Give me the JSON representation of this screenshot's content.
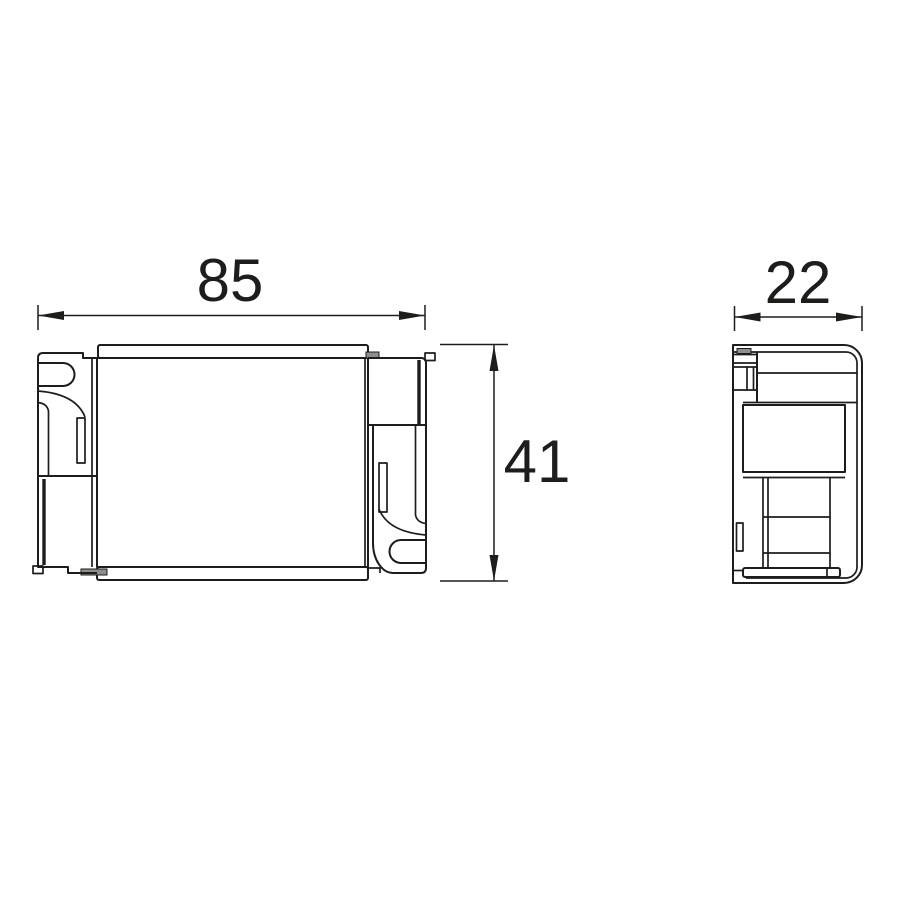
{
  "drawing": {
    "title": "control-gear-dimension-drawing",
    "dimensions": {
      "width_label": "85",
      "height_label": "41",
      "depth_label": "22"
    },
    "colors": {
      "line": "#1d1d1b",
      "tab-fill": "#8e8e8e",
      "background": "#ffffff"
    }
  }
}
